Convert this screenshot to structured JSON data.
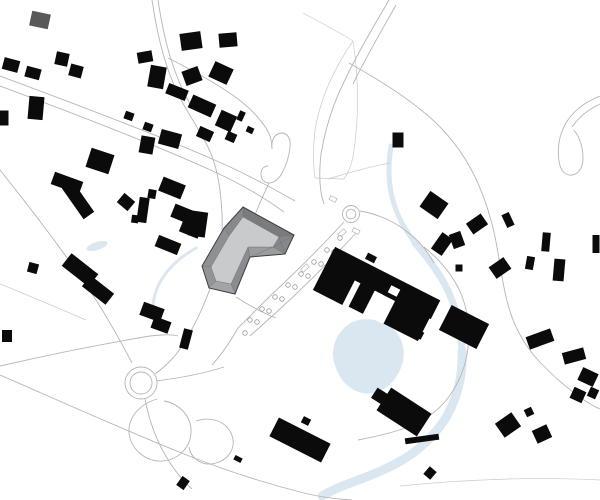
{
  "canvas": {
    "width": 600,
    "height": 500,
    "background": "#ffffff"
  },
  "palette": {
    "building": "#0b0b0b",
    "building_gray": "#58595b",
    "road": "#b5b5b5",
    "boundary": "#cbcbcb",
    "water": "#dae7f1",
    "roof_outline": "#3f3f40",
    "roof_top": "#c9cacc",
    "roof_edge": "#6f7174",
    "tree_stroke": "#9a9a9a",
    "white": "#ffffff"
  },
  "map": {
    "water_paths": [
      {
        "d": "M391,146 C388,166 388,186 394,204 C398,218 406,231 415,243",
        "w": 5
      },
      {
        "d": "M415,243 C429,259 441,275 449,293 C457,311 461,331 462,351",
        "w": 7
      },
      {
        "d": "M462,351 C463,373 458,395 448,414 C438,432 422,448 404,459 C386,470 364,478 345,485 C337,488 329,492 322,496",
        "w": 9
      },
      {
        "d": "M196,248 C180,257 167,269 159,284 C153,296 151,310 155,323",
        "w": 3
      }
    ],
    "pond_path": "M352,322 C368,316 386,320 396,332 C406,344 406,360 398,374 C390,388 376,396 362,393 C348,390 338,378 334,362 C330,346 338,330 352,322 Z",
    "water_blobs": [
      {
        "cx": 97,
        "cy": 246,
        "rx": 11,
        "ry": 4,
        "rot": -18
      }
    ],
    "boundaries": [
      "M303,13 C320,22 337,31 353,41",
      "M353,41 C333,70 320,100 315,130 C313,148 313,164 315,178",
      "M353,41 C359,80 359,120 353,157 C351,166 348,173 344,179",
      "M315,178 L344,179",
      "M328,179 C348,173 368,167 390,163",
      "M0,284 C30,296 58,308 86,320",
      "M400,486 C470,479 540,477 600,480"
    ],
    "roads": [
      "M0,76 C70,102 150,132 210,158 C245,173 272,188 295,201",
      "M0,86 C70,112 148,142 206,168 C238,182 262,196 284,212",
      "M152,0 C158,40 167,76 185,107 C193,121 201,133 208,147 C217,165 221,190 222,215 C223,235 221,252 216,270 C208,298 196,324 182,346 C173,360 163,368 155,374",
      "M158,0 C164,40 173,74 190,104",
      "M168,58 C192,70 214,82 234,96 C248,106 258,116 266,128 C270,134 272,142 272,149",
      "M272,149 C271,141 274,134 281,133 C288,133 291,139 290,147 C289,157 286,166 282,173 C279,179 274,183 269,183 C264,183 261,179 261,174 C261,169 264,166 268,166",
      "M269,183 C264,194 260,202 257,210 C254,217 252,224 251,231",
      "M389,0 C374,26 357,54 344,82 C333,104 325,130 321,154 C319,172 319,190 324,204",
      "M396,5 C382,30 366,57 353,84",
      "M349,63 C374,77 399,92 421,110 C439,124 455,142 467,162 C479,182 487,204 493,228 C499,252 501,278 507,301 C513,325 524,345 539,361 C553,376 568,389 584,400 C590,404 595,407 600,409",
      "M360,211 C378,214 396,222 410,234 C420,242 428,252 434,263",
      "M344,222 C320,248 294,274 268,298 C258,308 248,318 238,328",
      "M356,233 C332,259 306,285 280,309 C270,318 260,327 250,336",
      "M238,328 C230,342 222,354 212,365",
      "M0,170 C32,210 66,254 96,300 C110,322 122,344 132,363",
      "M0,366 C52,354 102,344 150,336 C160,335 170,334 178,336",
      "M0,375 C62,402 124,430 184,454 C224,470 264,483 304,493 C320,497 336,499 352,500",
      "M157,399 C140,404 128,417 129,433 C131,450 146,462 163,461 C180,459 192,446 191,429 C190,415 178,403 164,401",
      "M196,421 C211,416 225,421 231,433 C237,446 230,459 216,463 C203,467 191,459 189,447",
      "M156,381 C180,378 202,374 224,367",
      "M145,399 C149,420 156,440 167,458 C174,470 182,480 192,489",
      "M228,222 C243,231 257,239 270,246",
      "M236,297 C250,306 263,313 276,318",
      "M222,260 C228,266 234,270 242,274",
      "M600,96 C585,102 573,111 566,123 C559,135 557,149 559,161 C560,170 565,176 572,175 C579,174 583,167 583,158 C583,148 580,138 574,130",
      "M600,104 C589,109 579,117 572,127",
      "M424,247 C440,260 454,276 462,296 C468,312 470,330 468,348 C466,366 459,383 448,398 C438,411 424,421 408,427 C392,433 374,437 358,440"
    ],
    "roundabouts": [
      {
        "cx": 351,
        "cy": 214,
        "r_outer": 8.5,
        "r_inner": 4.8
      },
      {
        "cx": 141,
        "cy": 383,
        "r_outer": 16,
        "r_inner": 11
      }
    ],
    "ticks": [
      [
        342,
        233,
        8,
        4,
        -42
      ],
      [
        305,
        268,
        8,
        4,
        -42
      ],
      [
        333,
        199,
        7,
        4,
        25
      ],
      [
        356,
        231,
        7,
        4,
        25
      ]
    ],
    "trees": {
      "r": 2.3,
      "points": [
        [
          340,
          238
        ],
        [
          327,
          250
        ],
        [
          314,
          262
        ],
        [
          301,
          274
        ],
        [
          288,
          285
        ],
        [
          275,
          297
        ],
        [
          262,
          309
        ],
        [
          250,
          320
        ],
        [
          334,
          252
        ],
        [
          321,
          264
        ],
        [
          308,
          276
        ],
        [
          295,
          287
        ],
        [
          282,
          299
        ],
        [
          269,
          311
        ],
        [
          257,
          322
        ],
        [
          245,
          333
        ]
      ]
    },
    "buildings_gray": [
      [
        40,
        20,
        19,
        15,
        12
      ]
    ],
    "buildings_rect": [
      [
        11,
        65,
        16,
        12,
        15
      ],
      [
        33,
        73,
        15,
        11,
        15
      ],
      [
        62,
        59,
        13,
        13,
        12
      ],
      [
        76,
        71,
        13,
        12,
        15
      ],
      [
        36,
        108,
        15,
        23,
        5
      ],
      [
        4,
        118,
        9,
        15,
        0
      ],
      [
        145,
        57,
        15,
        11,
        -10
      ],
      [
        157,
        77,
        16,
        22,
        10
      ],
      [
        129,
        116,
        9,
        8,
        20
      ],
      [
        148,
        127,
        9,
        8,
        20
      ],
      [
        147,
        145,
        14,
        17,
        10
      ],
      [
        170,
        139,
        21,
        15,
        15
      ],
      [
        191,
        41,
        21,
        17,
        -8
      ],
      [
        228,
        40,
        18,
        14,
        -5
      ],
      [
        192,
        76,
        17,
        15,
        -20
      ],
      [
        221,
        73,
        20,
        17,
        25
      ],
      [
        177,
        92,
        21,
        11,
        22
      ],
      [
        202,
        106,
        25,
        14,
        24
      ],
      [
        226,
        121,
        17,
        17,
        24
      ],
      [
        241,
        116,
        6,
        10,
        24
      ],
      [
        250,
        130,
        7,
        6,
        24
      ],
      [
        205,
        134,
        15,
        11,
        24
      ],
      [
        231,
        137,
        10,
        9,
        24
      ],
      [
        100,
        161,
        24,
        20,
        18
      ],
      [
        67,
        183,
        30,
        13,
        20
      ],
      [
        78,
        200,
        38,
        13,
        55
      ],
      [
        126,
        202,
        14,
        12,
        40
      ],
      [
        143,
        210,
        10,
        25,
        8
      ],
      [
        135,
        219,
        7,
        8,
        8
      ],
      [
        152,
        194,
        8,
        9,
        10
      ],
      [
        172,
        188,
        24,
        15,
        22
      ],
      [
        185,
        215,
        26,
        14,
        22
      ],
      [
        191,
        228,
        20,
        15,
        22
      ],
      [
        168,
        245,
        24,
        12,
        22
      ],
      [
        198,
        224,
        17,
        25,
        8
      ],
      [
        33,
        268,
        10,
        10,
        15
      ],
      [
        80,
        270,
        34,
        16,
        38
      ],
      [
        98,
        290,
        30,
        14,
        38
      ],
      [
        152,
        312,
        22,
        14,
        20
      ],
      [
        161,
        325,
        18,
        12,
        20
      ],
      [
        186,
        339,
        9,
        20,
        15
      ],
      [
        7,
        336,
        10,
        12,
        0
      ],
      [
        398,
        140,
        11,
        15,
        0
      ],
      [
        464,
        327,
        42,
        28,
        27
      ],
      [
        434,
        205,
        22,
        19,
        35
      ],
      [
        477,
        224,
        18,
        13,
        -35
      ],
      [
        508,
        220,
        8,
        14,
        -25
      ],
      [
        442,
        244,
        13,
        20,
        35
      ],
      [
        457,
        240,
        12,
        15,
        -20
      ],
      [
        459,
        268,
        7,
        7,
        0
      ],
      [
        500,
        268,
        18,
        14,
        -35
      ],
      [
        530,
        263,
        8,
        13,
        10
      ],
      [
        546,
        242,
        8,
        19,
        5
      ],
      [
        559,
        270,
        11,
        22,
        5
      ],
      [
        596,
        244,
        7,
        18,
        0
      ],
      [
        540,
        339,
        26,
        13,
        -20
      ],
      [
        574,
        356,
        22,
        12,
        -15
      ],
      [
        588,
        377,
        17,
        14,
        25
      ],
      [
        578,
        395,
        13,
        12,
        25
      ],
      [
        593,
        393,
        9,
        10,
        25
      ],
      [
        508,
        425,
        20,
        17,
        -35
      ],
      [
        529,
        412,
        8,
        8,
        -25
      ],
      [
        542,
        434,
        16,
        14,
        -25
      ],
      [
        430,
        473,
        9,
        10,
        40
      ],
      [
        422,
        439,
        34,
        6,
        -8
      ],
      [
        404,
        412,
        48,
        27,
        33
      ],
      [
        381,
        397,
        16,
        12,
        33
      ],
      [
        300,
        440,
        58,
        21,
        27
      ],
      [
        238,
        459,
        8,
        5,
        27
      ],
      [
        306,
        421,
        8,
        7,
        27
      ],
      [
        183,
        483,
        9,
        11,
        35
      ]
    ],
    "complex_rects": [
      [
        383,
        283,
        118,
        21,
        27
      ],
      [
        338,
        277,
        33,
        46,
        27
      ],
      [
        363,
        296,
        16,
        32,
        27
      ],
      [
        404,
        311,
        52,
        41,
        27
      ],
      [
        371,
        258,
        10,
        7,
        27
      ],
      [
        418,
        334,
        10,
        8,
        27
      ]
    ],
    "complex_white": [
      [
        382,
        309,
        16,
        26,
        27
      ],
      [
        394,
        291,
        10,
        8,
        27
      ]
    ],
    "featured": {
      "footprint": [
        [
          243,
          207
        ],
        [
          294,
          235
        ],
        [
          285,
          254
        ],
        [
          250,
          257
        ],
        [
          235,
          294
        ],
        [
          209,
          288
        ],
        [
          202,
          266
        ],
        [
          224,
          228
        ]
      ],
      "roof_top": [
        [
          243,
          217
        ],
        [
          279,
          237
        ],
        [
          273,
          247
        ],
        [
          248,
          247
        ],
        [
          231,
          284
        ],
        [
          216,
          281
        ],
        [
          211,
          267
        ],
        [
          229,
          236
        ]
      ],
      "facet_fills": [
        "#797b7e",
        "#85878a",
        "#9a9c9f",
        "#8a8c8f",
        "#a2a4a7",
        "#929497",
        "#8e9093",
        "#87898c"
      ],
      "extra_lines": [
        [
          294,
          235,
          273,
          247
        ],
        [
          285,
          254,
          279,
          237
        ],
        [
          250,
          257,
          273,
          247
        ]
      ]
    }
  }
}
